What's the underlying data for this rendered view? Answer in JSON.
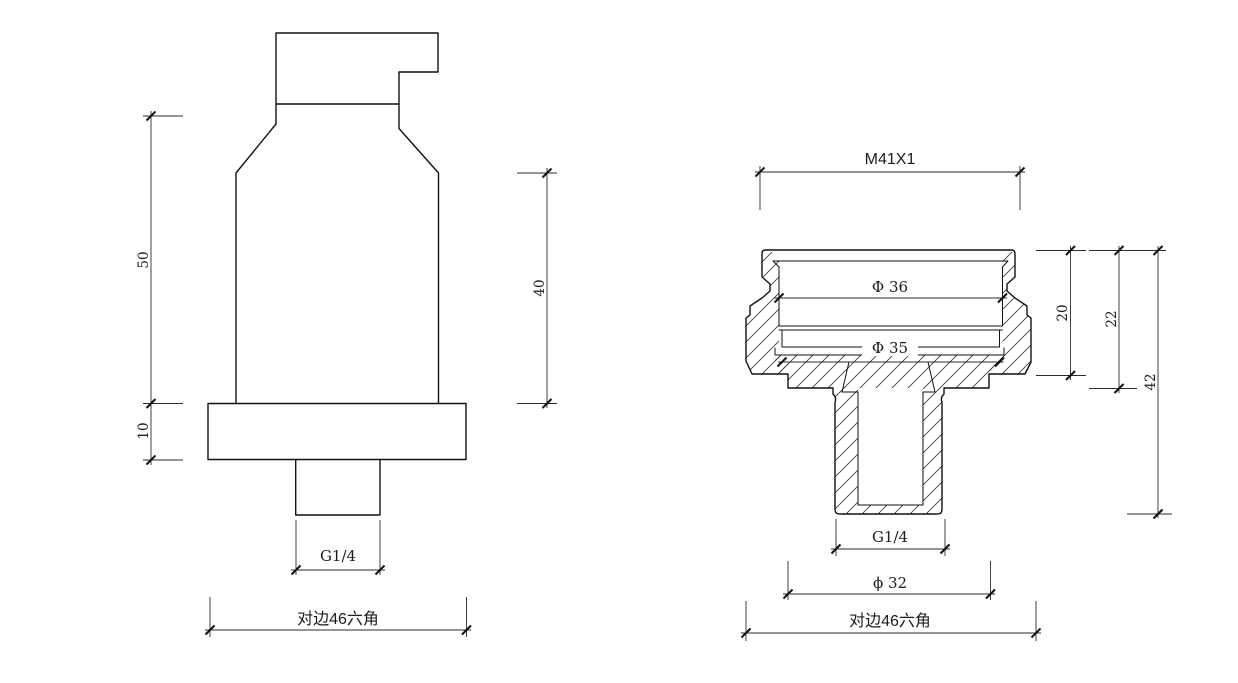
{
  "colors": {
    "background": "#ffffff",
    "object_line": "#111111",
    "dimension_line": "#2b2b2b",
    "text": "#1c1c1c"
  },
  "views": {
    "front": {
      "dim_height_50": "50",
      "dim_height_10": "10",
      "dim_height_40": "40",
      "dim_thread": "G1/4",
      "dim_hex": "对边46六角"
    },
    "section": {
      "dim_thread_top": "M41X1",
      "dim_dia36": "Φ 36",
      "dim_dia35": "Φ 35",
      "dim_h20": "20",
      "dim_h22": "22",
      "dim_h42": "42",
      "dim_thread_bottom": "G1/4",
      "dim_dia32": "ϕ 32",
      "dim_hex": "对边46六角"
    }
  }
}
